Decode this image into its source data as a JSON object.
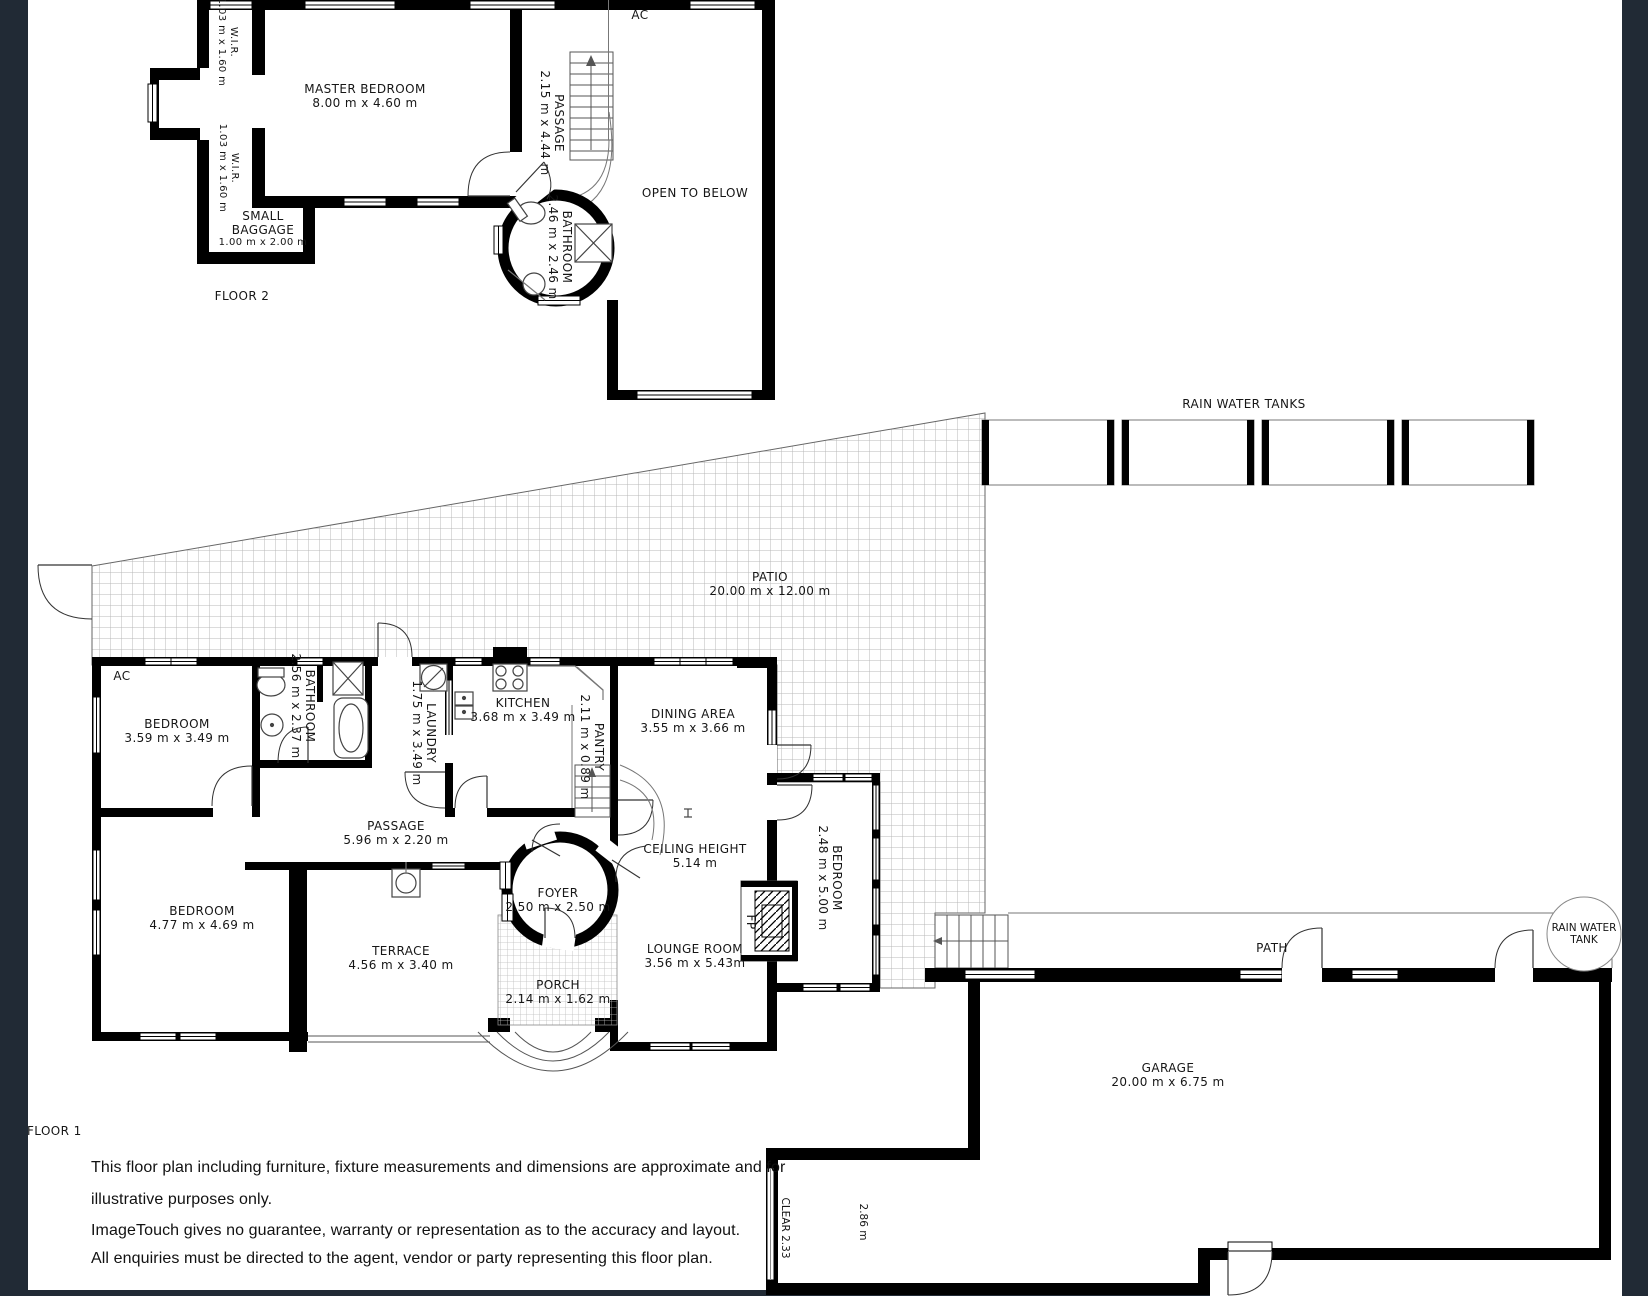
{
  "floor2": {
    "ac": "AC",
    "wir_top": {
      "name": "W.I.R.",
      "dims": "1.03 m x 1.60 m"
    },
    "wir_bottom": {
      "name": "W.I.R.",
      "dims": "1.03 m x 1.60 m"
    },
    "master_bedroom": {
      "name": "MASTER BEDROOM",
      "dims": "8.00 m x 4.60 m"
    },
    "passage": {
      "name": "PASSAGE",
      "dims": "2.15 m x 4.44 m"
    },
    "bathroom": {
      "name": "BATHROOM",
      "dims": "2.46 m x 2.46 m"
    },
    "open_to_below": "OPEN TO BELOW",
    "small_baggage": {
      "line1": "SMALL",
      "line2": "BAGGAGE",
      "dims": "1.00 m x 2.00 m"
    },
    "label": "FLOOR 2"
  },
  "floor1": {
    "rain_water_tanks_label": "RAIN WATER TANKS",
    "patio": {
      "name": "PATIO",
      "dims": "20.00 m x 12.00 m"
    },
    "ac": "AC",
    "bedroom_left": {
      "name": "BEDROOM",
      "dims": "3.59 m x 3.49 m"
    },
    "bathroom": {
      "name": "BATHROOM",
      "dims": "2.56 m x 2.37 m"
    },
    "laundry": {
      "name": "LAUNDRY",
      "dims": "1.75 m x 3.49 m"
    },
    "kitchen": {
      "name": "KITCHEN",
      "dims": "3.68 m x 3.49 m"
    },
    "pantry": {
      "name": "PANTRY",
      "dims": "2.11 m x 0.89 m"
    },
    "dining": {
      "name": "DINING AREA",
      "dims": "3.55 m x 3.66 m"
    },
    "passage": {
      "name": "PASSAGE",
      "dims": "5.96 m x 2.20 m"
    },
    "ceiling_height": {
      "name": "CEILING HEIGHT",
      "dims": "5.14 m"
    },
    "foyer": {
      "name": "FOYER",
      "dims": "2.50 m x 2.50 m"
    },
    "bedroom_right": {
      "name": "BEDROOM",
      "dims": "2.48 m x 5.00 m"
    },
    "bedroom_bottom": {
      "name": "BEDROOM",
      "dims": "4.77 m x 4.69 m"
    },
    "terrace": {
      "name": "TERRACE",
      "dims": "4.56 m x 3.40 m"
    },
    "porch": {
      "name": "PORCH",
      "dims": "2.14 m x 1.62 m"
    },
    "lounge": {
      "name": "LOUNGE ROOM",
      "dims": "3.56 m x 5.43m"
    },
    "fp": "FP",
    "path_label": "PATH",
    "rain_water_tank_circle": {
      "line1": "RAIN WATER",
      "line2": "TANK"
    },
    "garage": {
      "name": "GARAGE",
      "dims": "20.00 m x 6.75 m"
    },
    "clear": "CLEAR 2.33",
    "clearance": "2.86 m",
    "label": "FLOOR 1"
  },
  "disclaimer": {
    "line1": "This floor plan including furniture, fixture measurements and dimensions are approximate and for",
    "line2": "illustrative purposes only.",
    "line3": "ImageTouch gives no guarantee, warranty or representation as to the accuracy and layout.",
    "line4": "All enquiries must be directed to the agent, vendor or party representing this floor plan."
  },
  "colors": {
    "background": "#212a35",
    "plan": "#ffffff",
    "wall": "#000000"
  }
}
